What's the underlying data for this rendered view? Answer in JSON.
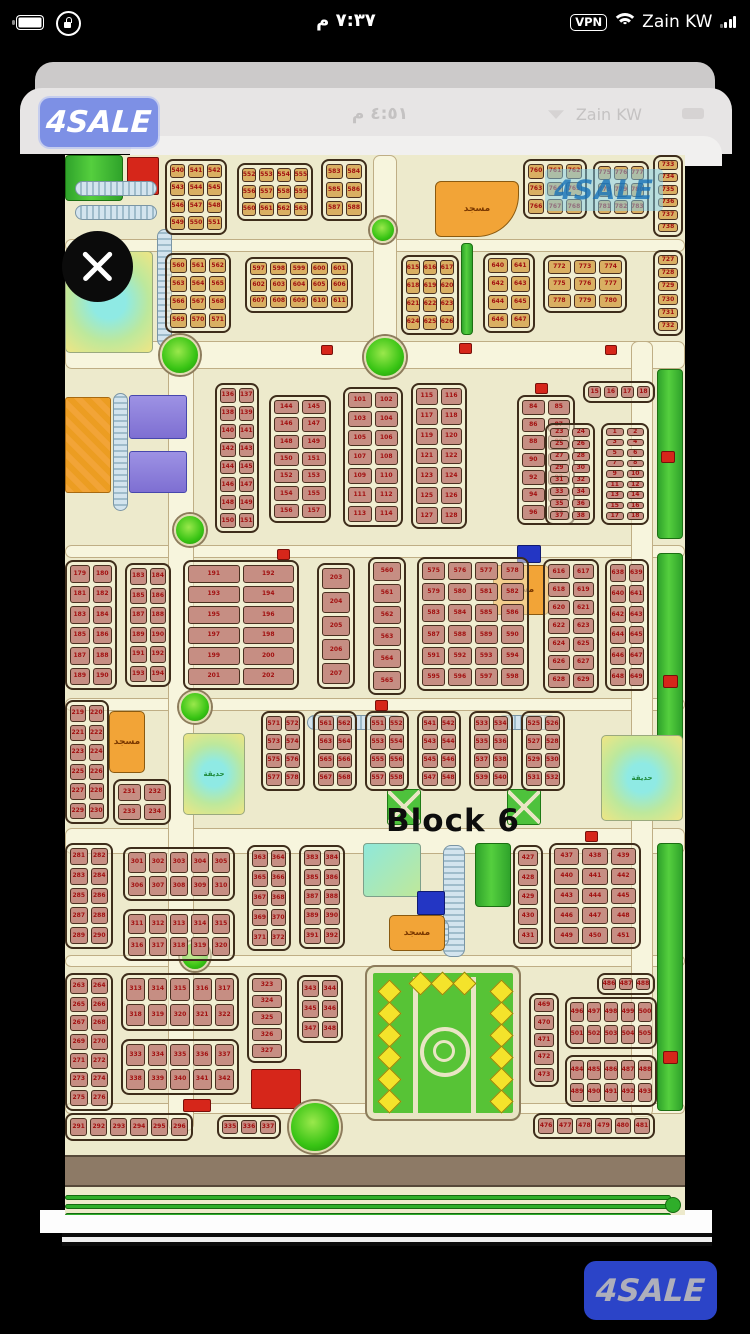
{
  "status_bar": {
    "time": "٧:٣٧ م",
    "carrier": "Zain KW",
    "vpn": "VPN"
  },
  "viewer": {
    "inner_time": "٤:٥١ م",
    "inner_carrier": "Zain KW"
  },
  "branding": {
    "app_logo": "4SALE",
    "footer_logo": "4SALE"
  },
  "map": {
    "block_label": "Block 6",
    "watermark": "4SALE",
    "districts": [
      [
        100,
        4,
        62,
        76,
        3,
        4,
        540,
        "tan"
      ],
      [
        172,
        8,
        76,
        58,
        4,
        3,
        552,
        "tan"
      ],
      [
        256,
        4,
        46,
        62,
        2,
        3,
        583,
        "tan"
      ],
      [
        458,
        4,
        64,
        60,
        3,
        3,
        760,
        "tan"
      ],
      [
        528,
        6,
        56,
        58,
        3,
        3,
        775,
        "tan"
      ],
      [
        588,
        0,
        30,
        82,
        1,
        6,
        733,
        "tan"
      ],
      [
        100,
        98,
        66,
        80,
        3,
        4,
        560,
        "tan"
      ],
      [
        180,
        102,
        108,
        56,
        5,
        3,
        597,
        "tan"
      ],
      [
        336,
        100,
        58,
        80,
        3,
        4,
        615,
        "tan"
      ],
      [
        418,
        98,
        52,
        80,
        2,
        4,
        640,
        "tan"
      ],
      [
        478,
        100,
        84,
        58,
        3,
        3,
        772,
        "tan"
      ],
      [
        588,
        95,
        30,
        86,
        1,
        6,
        727,
        "tan"
      ],
      [
        150,
        228,
        44,
        150,
        2,
        8,
        136,
        "pink"
      ],
      [
        204,
        240,
        62,
        128,
        2,
        7,
        144,
        "pink"
      ],
      [
        278,
        232,
        60,
        140,
        2,
        7,
        101,
        "pink"
      ],
      [
        346,
        228,
        56,
        146,
        2,
        7,
        115,
        "pink"
      ],
      [
        452,
        240,
        58,
        130,
        2,
        7,
        84,
        "pink"
      ],
      [
        518,
        226,
        72,
        22,
        4,
        1,
        15,
        "pink"
      ],
      [
        480,
        268,
        50,
        102,
        2,
        8,
        23,
        "pink"
      ],
      [
        536,
        268,
        48,
        102,
        2,
        9,
        1,
        "pink"
      ],
      [
        0,
        405,
        52,
        130,
        2,
        6,
        179,
        "pink"
      ],
      [
        60,
        408,
        46,
        124,
        2,
        6,
        183,
        "pink"
      ],
      [
        118,
        405,
        116,
        130,
        2,
        6,
        191,
        "pink"
      ],
      [
        252,
        408,
        38,
        126,
        1,
        5,
        203,
        "pink"
      ],
      [
        303,
        402,
        38,
        138,
        1,
        6,
        560,
        "pink"
      ],
      [
        352,
        402,
        112,
        134,
        4,
        6,
        575,
        "pink"
      ],
      [
        478,
        404,
        56,
        134,
        2,
        7,
        616,
        "pink"
      ],
      [
        540,
        404,
        44,
        132,
        2,
        6,
        638,
        "pink"
      ],
      [
        0,
        545,
        44,
        124,
        2,
        6,
        219,
        "pink"
      ],
      [
        48,
        624,
        58,
        46,
        2,
        2,
        231,
        "pink"
      ],
      [
        196,
        556,
        44,
        80,
        2,
        4,
        571,
        "pink"
      ],
      [
        248,
        556,
        44,
        80,
        2,
        4,
        561,
        "pink"
      ],
      [
        300,
        556,
        44,
        80,
        2,
        4,
        551,
        "pink"
      ],
      [
        352,
        556,
        44,
        80,
        2,
        4,
        541,
        "pink"
      ],
      [
        404,
        556,
        44,
        80,
        2,
        4,
        533,
        "pink"
      ],
      [
        456,
        556,
        44,
        80,
        2,
        4,
        525,
        "pink"
      ],
      [
        0,
        688,
        48,
        106,
        2,
        5,
        281,
        "pink"
      ],
      [
        58,
        692,
        112,
        54,
        5,
        2,
        301,
        "pink"
      ],
      [
        58,
        754,
        112,
        52,
        5,
        2,
        311,
        "pink"
      ],
      [
        182,
        690,
        44,
        106,
        2,
        5,
        363,
        "pink"
      ],
      [
        234,
        690,
        46,
        104,
        2,
        5,
        383,
        "pink"
      ],
      [
        448,
        690,
        30,
        104,
        1,
        5,
        427,
        "pink"
      ],
      [
        484,
        688,
        92,
        106,
        3,
        5,
        437,
        "pink"
      ],
      [
        0,
        818,
        48,
        138,
        2,
        7,
        263,
        "pink"
      ],
      [
        56,
        818,
        118,
        58,
        5,
        2,
        313,
        "pink"
      ],
      [
        56,
        884,
        118,
        56,
        5,
        2,
        333,
        "pink"
      ],
      [
        182,
        818,
        40,
        90,
        1,
        5,
        323,
        "pink"
      ],
      [
        232,
        820,
        46,
        68,
        2,
        3,
        343,
        "pink"
      ],
      [
        532,
        818,
        58,
        22,
        3,
        1,
        486,
        "pink"
      ],
      [
        464,
        838,
        30,
        94,
        1,
        5,
        469,
        "pink"
      ],
      [
        500,
        842,
        92,
        52,
        5,
        2,
        496,
        "pink"
      ],
      [
        500,
        900,
        92,
        52,
        5,
        2,
        484,
        "pink"
      ],
      [
        468,
        958,
        122,
        26,
        6,
        1,
        476,
        "pink"
      ],
      [
        0,
        958,
        128,
        28,
        6,
        1,
        291,
        "pink"
      ],
      [
        152,
        960,
        64,
        24,
        3,
        1,
        335,
        "pink"
      ]
    ],
    "features": [
      {
        "t": "street",
        "x": 0,
        "y": 84,
        "w": 620,
        "h": 13
      },
      {
        "t": "street",
        "x": 0,
        "y": 186,
        "w": 620,
        "h": 28
      },
      {
        "t": "street",
        "x": 0,
        "y": 390,
        "w": 620,
        "h": 13
      },
      {
        "t": "street",
        "x": 0,
        "y": 543,
        "w": 620,
        "h": 13
      },
      {
        "t": "street",
        "x": 0,
        "y": 673,
        "w": 620,
        "h": 26
      },
      {
        "t": "street",
        "x": 0,
        "y": 800,
        "w": 620,
        "h": 12
      },
      {
        "t": "street",
        "x": 0,
        "y": 948,
        "w": 620,
        "h": 11
      },
      {
        "t": "street",
        "x": 103,
        "y": 186,
        "w": 26,
        "h": 790
      },
      {
        "t": "street",
        "x": 308,
        "y": 0,
        "w": 24,
        "h": 190
      },
      {
        "t": "street",
        "x": 566,
        "y": 186,
        "w": 22,
        "h": 776
      },
      {
        "t": "road",
        "x": 0,
        "y": 1000,
        "w": 620,
        "h": 32
      },
      {
        "t": "curve",
        "x": 0,
        "y": 1040,
        "w": 606,
        "h": 5
      },
      {
        "t": "curve",
        "x": 0,
        "y": 1049,
        "w": 606,
        "h": 5
      },
      {
        "t": "curve",
        "x": 0,
        "y": 1058,
        "w": 606,
        "h": 5
      },
      {
        "t": "cap",
        "x": 600,
        "y": 1042,
        "w": 16,
        "h": 16
      },
      {
        "t": "green",
        "x": 592,
        "y": 214,
        "w": 26,
        "h": 170
      },
      {
        "t": "green",
        "x": 592,
        "y": 398,
        "w": 26,
        "h": 266
      },
      {
        "t": "green",
        "x": 592,
        "y": 688,
        "w": 26,
        "h": 268
      },
      {
        "t": "green",
        "x": 396,
        "y": 88,
        "w": 12,
        "h": 92
      },
      {
        "t": "green",
        "x": 0,
        "y": 0,
        "w": 58,
        "h": 46
      },
      {
        "t": "green",
        "x": 410,
        "y": 688,
        "w": 36,
        "h": 64
      },
      {
        "t": "red",
        "x": 62,
        "y": 2,
        "w": 32,
        "h": 38
      },
      {
        "t": "pond",
        "x": 0,
        "y": 96,
        "w": 88,
        "h": 102,
        "label": ""
      },
      {
        "t": "pond",
        "x": 118,
        "y": 578,
        "w": 62,
        "h": 82,
        "label": "حديقة"
      },
      {
        "t": "pond",
        "x": 536,
        "y": 580,
        "w": 82,
        "h": 86,
        "label": "حديقة"
      },
      {
        "t": "parkh",
        "x": 10,
        "y": 26,
        "w": 82,
        "h": 15
      },
      {
        "t": "parkh",
        "x": 10,
        "y": 50,
        "w": 82,
        "h": 15
      },
      {
        "t": "parkv",
        "x": 92,
        "y": 74,
        "w": 15,
        "h": 118
      },
      {
        "t": "parkv",
        "x": 48,
        "y": 238,
        "w": 15,
        "h": 118
      },
      {
        "t": "parkh",
        "x": 242,
        "y": 560,
        "w": 96,
        "h": 15
      },
      {
        "t": "parkh",
        "x": 432,
        "y": 560,
        "w": 60,
        "h": 15
      },
      {
        "t": "parkv",
        "x": 378,
        "y": 690,
        "w": 22,
        "h": 112
      },
      {
        "t": "parkv",
        "x": 348,
        "y": 764,
        "w": 36,
        "h": 28
      },
      {
        "t": "teal",
        "x": 298,
        "y": 688,
        "w": 58,
        "h": 54
      },
      {
        "t": "blue",
        "x": 352,
        "y": 736,
        "w": 28,
        "h": 24
      },
      {
        "t": "blue",
        "x": 452,
        "y": 390,
        "w": 24,
        "h": 18
      },
      {
        "t": "orangeblock",
        "x": 0,
        "y": 242,
        "w": 46,
        "h": 96
      },
      {
        "t": "purple",
        "x": 64,
        "y": 240,
        "w": 58,
        "h": 44
      },
      {
        "t": "purple",
        "x": 64,
        "y": 296,
        "w": 58,
        "h": 42
      },
      {
        "t": "mosque",
        "x": 370,
        "y": 26,
        "w": 84,
        "h": 56,
        "label": "مسجد",
        "fan": 1
      },
      {
        "t": "mosque",
        "x": 428,
        "y": 410,
        "w": 56,
        "h": 50,
        "label": "مسجد"
      },
      {
        "t": "mosque",
        "x": 44,
        "y": 556,
        "w": 36,
        "h": 62,
        "label": "مسجد"
      },
      {
        "t": "mosque",
        "x": 324,
        "y": 760,
        "w": 56,
        "h": 36,
        "label": "مسجد"
      },
      {
        "t": "red",
        "x": 186,
        "y": 914,
        "w": 50,
        "h": 40
      },
      {
        "t": "xpark",
        "x": 322,
        "y": 634,
        "w": 34,
        "h": 36
      },
      {
        "t": "xpark",
        "x": 442,
        "y": 634,
        "w": 34,
        "h": 36
      },
      {
        "t": "red",
        "x": 394,
        "y": 188,
        "w": 13,
        "h": 11
      },
      {
        "t": "red",
        "x": 256,
        "y": 190,
        "w": 12,
        "h": 10
      },
      {
        "t": "red",
        "x": 540,
        "y": 190,
        "w": 12,
        "h": 10
      },
      {
        "t": "red",
        "x": 212,
        "y": 394,
        "w": 13,
        "h": 11
      },
      {
        "t": "red",
        "x": 470,
        "y": 228,
        "w": 13,
        "h": 11
      },
      {
        "t": "red",
        "x": 310,
        "y": 545,
        "w": 13,
        "h": 11
      },
      {
        "t": "red",
        "x": 520,
        "y": 676,
        "w": 13,
        "h": 11
      },
      {
        "t": "red",
        "x": 118,
        "y": 944,
        "w": 28,
        "h": 13
      },
      {
        "t": "red",
        "x": 596,
        "y": 296,
        "w": 14,
        "h": 12
      },
      {
        "t": "red",
        "x": 598,
        "y": 520,
        "w": 15,
        "h": 13
      },
      {
        "t": "red",
        "x": 598,
        "y": 896,
        "w": 15,
        "h": 13
      },
      {
        "t": "red",
        "x": 352,
        "y": 940,
        "w": 12,
        "h": 11
      },
      {
        "t": "round",
        "x": 305,
        "y": 62,
        "w": 26,
        "h": 26
      },
      {
        "t": "round",
        "x": 95,
        "y": 180,
        "w": 40,
        "h": 40
      },
      {
        "t": "round",
        "x": 299,
        "y": 181,
        "w": 42,
        "h": 42
      },
      {
        "t": "round",
        "x": 109,
        "y": 359,
        "w": 32,
        "h": 32
      },
      {
        "t": "round",
        "x": 114,
        "y": 536,
        "w": 32,
        "h": 32
      },
      {
        "t": "round",
        "x": 115,
        "y": 786,
        "w": 30,
        "h": 30
      },
      {
        "t": "round",
        "x": 224,
        "y": 946,
        "w": 52,
        "h": 52
      },
      {
        "t": "garden",
        "x": 300,
        "y": 810,
        "w": 156,
        "h": 156
      }
    ],
    "overlays": [
      {
        "t": "wm",
        "x": 480,
        "y": 14,
        "w": 118,
        "h": 42,
        "key": "watermark"
      },
      {
        "t": "label",
        "x": 318,
        "y": 646,
        "w": 140,
        "h": 40,
        "key": "block_label"
      }
    ]
  }
}
